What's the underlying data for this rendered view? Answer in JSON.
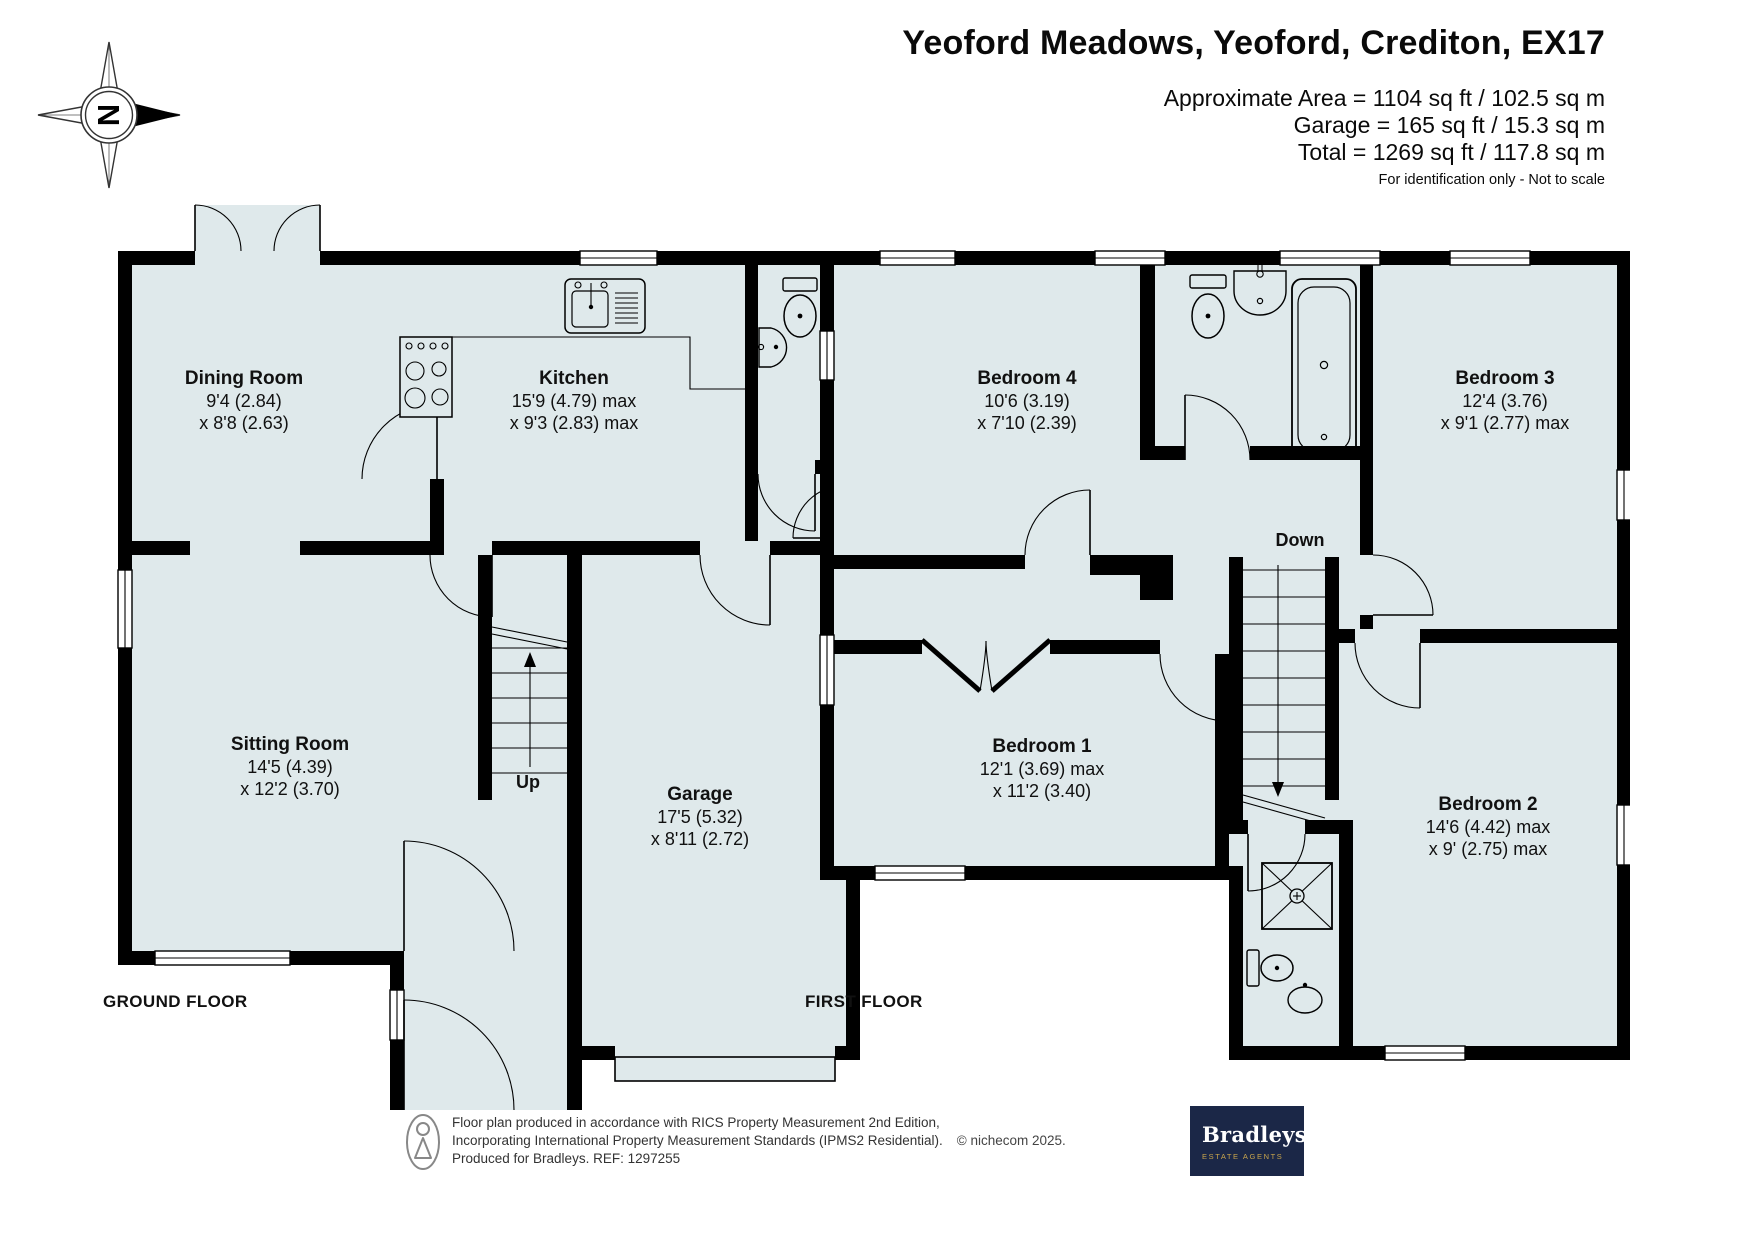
{
  "header": {
    "title": "Yeoford Meadows, Yeoford, Crediton, EX17",
    "area_line1": "Approximate Area = 1104 sq ft / 102.5 sq m",
    "area_line2": "Garage = 165 sq ft / 15.3 sq m",
    "area_line3": "Total = 1269 sq ft / 117.8 sq m",
    "disclaimer": "For identification only - Not to scale"
  },
  "compass": {
    "north_label": "N"
  },
  "ground_floor": {
    "floor_label": "GROUND FLOOR",
    "stairs_label": "Up",
    "rooms": [
      {
        "name": "Dining Room",
        "dim1": "9'4 (2.84)",
        "dim2": "x 8'8 (2.63)"
      },
      {
        "name": "Kitchen",
        "dim1": "15'9 (4.79) max",
        "dim2": "x 9'3 (2.83) max"
      },
      {
        "name": "Sitting Room",
        "dim1": "14'5 (4.39)",
        "dim2": "x 12'2 (3.70)"
      },
      {
        "name": "Garage",
        "dim1": "17'5 (5.32)",
        "dim2": "x 8'11 (2.72)"
      }
    ]
  },
  "first_floor": {
    "floor_label": "FIRST FLOOR",
    "stairs_label": "Down",
    "rooms": [
      {
        "name": "Bedroom 4",
        "dim1": "10'6 (3.19)",
        "dim2": "x 7'10 (2.39)"
      },
      {
        "name": "Bedroom 3",
        "dim1": "12'4 (3.76)",
        "dim2": "x 9'1 (2.77) max"
      },
      {
        "name": "Bedroom 1",
        "dim1": "12'1 (3.69) max",
        "dim2": "x 11'2 (3.40)"
      },
      {
        "name": "Bedroom 2",
        "dim1": "14'6 (4.42) max",
        "dim2": "x 9' (2.75) max"
      }
    ]
  },
  "footer": {
    "line1": "Floor plan produced in accordance with RICS Property Measurement 2nd Edition,",
    "line2": "Incorporating International Property Measurement Standards (IPMS2 Residential).",
    "copyright": "© nichecom 2025.",
    "line3": "Produced for Bradleys.   REF: 1297255",
    "logo_name": "Bradleys",
    "logo_tagline": "ESTATE AGENTS"
  },
  "colors": {
    "room_fill": "#dfe9eb",
    "wall": "#000000",
    "logo_bg": "#1b2747",
    "logo_gold": "#c9a54c"
  }
}
